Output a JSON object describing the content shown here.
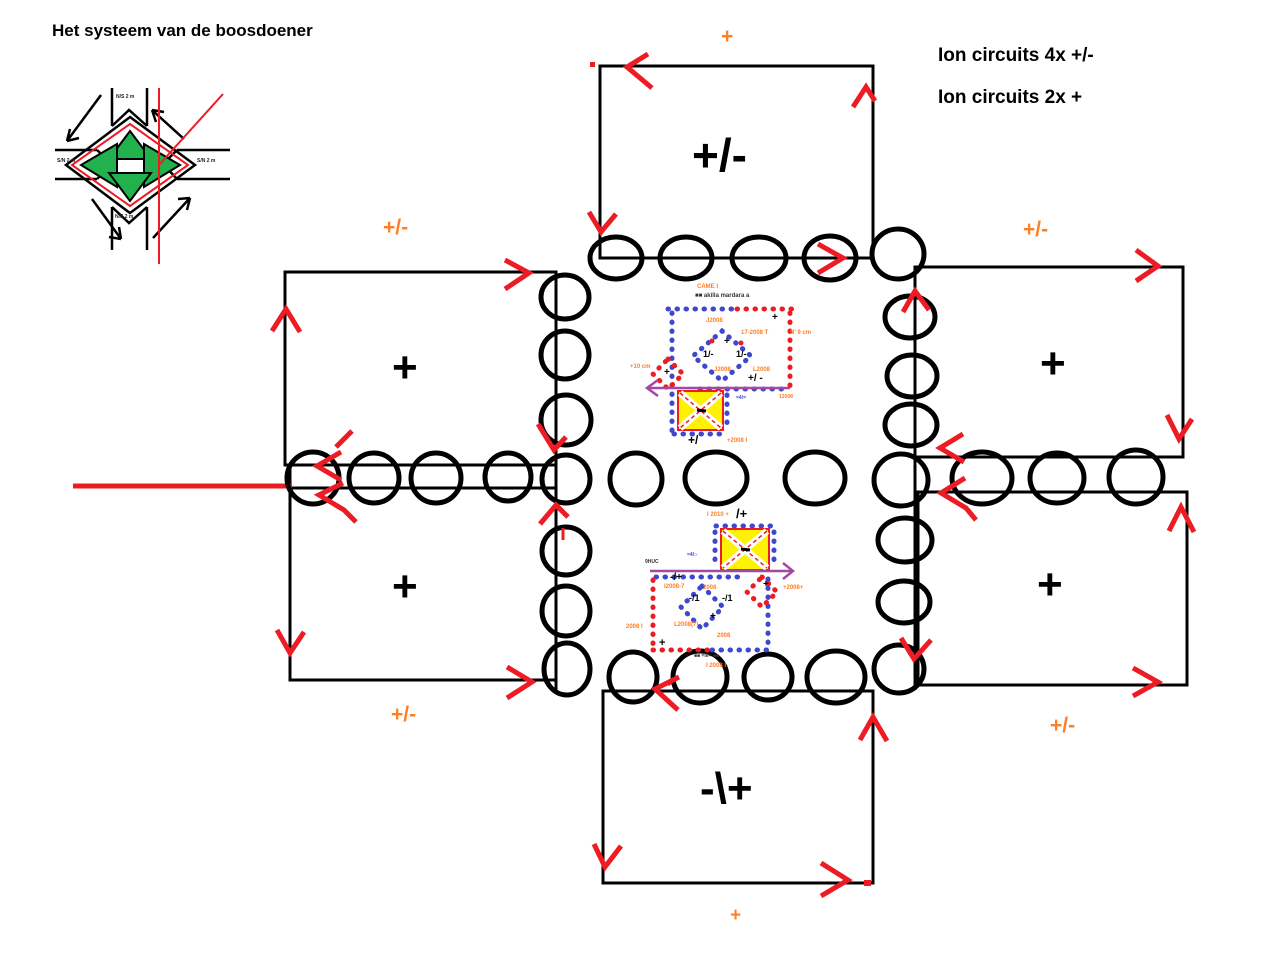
{
  "title": "Het systeem van de boosdoener",
  "legend": {
    "line1": "Ion circuits 4x +/-",
    "line2": "Ion circuits 2x +"
  },
  "cells": {
    "top": "+/-",
    "upper_left": "+",
    "lower_left": "+",
    "upper_right": "+",
    "lower_right": "+",
    "bottom": "-\\+"
  },
  "flow_labels": {
    "top": "+",
    "upper_left": "+/-",
    "upper_right": "+/-",
    "lower_left": "+/-",
    "lower_right": "+/-",
    "bottom": "+"
  },
  "intersection": {
    "roads": {
      "top": "N/S 2 m",
      "left": "S/N 2 m",
      "right": "S/N 2 m",
      "bottom": "N/S 2 m"
    }
  },
  "circuit_upper": {
    "t1": "CAME I",
    "t2": "■■ akilla mardara a",
    "t3": "J2008",
    "t4": "17-2008 T",
    "t5": "+",
    "t6": "1/-",
    "t7": "1/-",
    "t8": "J2008",
    "t9": "L2008",
    "t10": "+/ -",
    "t11": "+",
    "t12": "N' 9 cm",
    "t13": "+10 cm",
    "t14": "+",
    "t15": "+/",
    "t16": "+2008 I",
    "t17": "=4/=",
    "t18": "12008"
  },
  "circuit_lower": {
    "b1": "I 2010 +",
    "b2": "/+",
    "b3": "=4/:-",
    "b4": "9HUC",
    "b5": "-/+",
    "b6": "I2008-7",
    "b7": "2008",
    "b8": "-/1",
    "b9": "-/1",
    "b10": "L2008(7)",
    "b11": "+",
    "b12": "2008",
    "b13": "+",
    "b14": "+2008+",
    "b15": "+",
    "b16": "2008 I",
    "b17": "■■ =III= ■■",
    "b18": "I 2008 I"
  },
  "colors": {
    "orange": "#FF7F27",
    "red": "#ED1C24",
    "green": "#22B14C",
    "yellow": "#FFF200",
    "purple": "#A349A4",
    "blue": "#3F48CC"
  }
}
